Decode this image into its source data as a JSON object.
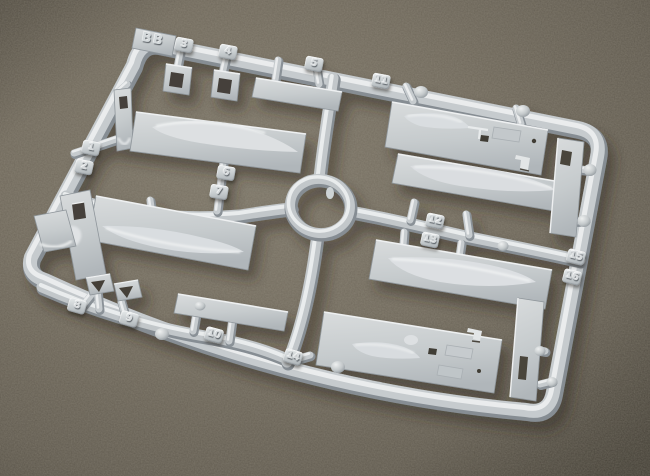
{
  "photo": {
    "subject": "Light gray injection-molded plastic model kit sprue (parts tree) photographed at an angle on a dark olive-brown textured surface",
    "sprue_label": "BB",
    "tabs": [
      "1",
      "2",
      "3",
      "4",
      "5",
      "6",
      "7",
      "8",
      "9",
      "10",
      "11",
      "12",
      "13",
      "14",
      "15",
      "16"
    ],
    "parts": [
      "rounded-rectangular-frame",
      "center-ring-runner",
      "upper-left-float-half",
      "lower-left-float-half",
      "left-panel-with-hole",
      "left-hull-tip",
      "small-bracket-a",
      "small-bracket-b",
      "thin-strip-top",
      "top-right-deck-plate",
      "right-float-half-upper",
      "right-float-half-lower",
      "bottom-right-deck-plate",
      "right-strip-upper",
      "right-strip-lower",
      "bottom-strip",
      "cleat-a",
      "cleat-b",
      "small-fin"
    ],
    "colors": {
      "plastic": "#c6cbce",
      "plastic_highlight": "#eaeced",
      "plastic_shadow": "#8a9197",
      "background": "#6e675a",
      "cast_shadow": "#2e2a22",
      "recess_dark": "#45403a"
    }
  }
}
